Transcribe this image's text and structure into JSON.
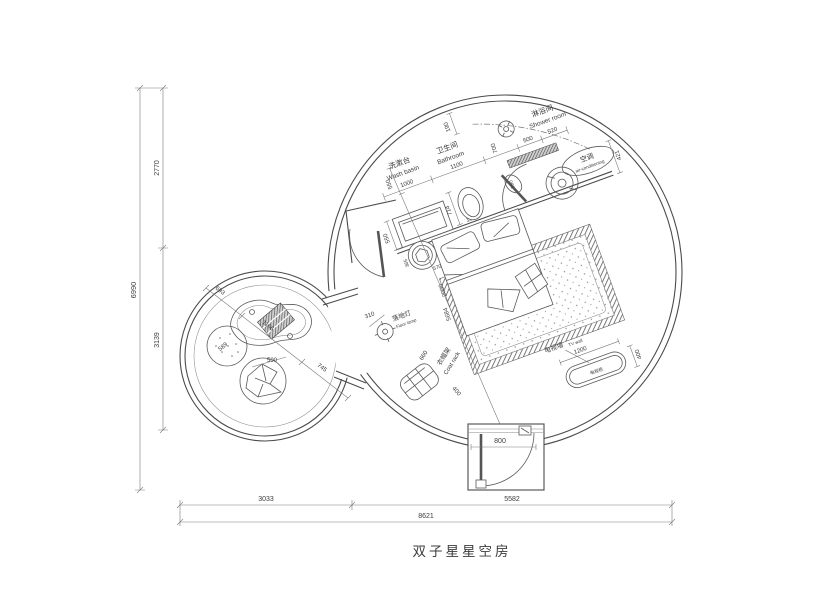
{
  "title": "双子星星空房",
  "rooms": {
    "washbasin": {
      "cn": "洗漱台",
      "en": "Wash basin"
    },
    "bathroom": {
      "cn": "卫生间",
      "en": "Bathroom"
    },
    "shower": {
      "cn": "淋浴间",
      "en": "Shower room"
    },
    "ac": {
      "cn": "空调",
      "en": "air-conditioning"
    },
    "tv_wall": {
      "cn": "电视墙",
      "en": "TV wall"
    },
    "tv_cabinet": {
      "cn": "电视柜"
    },
    "floor_lamp": {
      "cn": "落地灯",
      "en": "Floor lamp"
    },
    "coat_rack": {
      "cn": "衣帽架",
      "en": "Coat rack"
    }
  },
  "dims": {
    "overall_w": "8621",
    "w_left": "3033",
    "w_right": "5582",
    "overall_h": "6990",
    "h_top": "2770",
    "h_mid": "3139",
    "chain_washbasin": "1000",
    "chain_bathroom": "1100",
    "chain_door": "700",
    "chain_shower": "500",
    "chain_step": "520",
    "ac_depth": "421",
    "wall_gap": "190",
    "toilet": "714",
    "vanity_depth": "550",
    "door_leaf": "590",
    "bed_w": "1800",
    "bed_l": "2000",
    "room_diag": "5684",
    "stool_a": "365",
    "stool_b": "570",
    "tv_w": "1200",
    "tv_d": "400",
    "coat_w": "660",
    "coat_d": "400",
    "lamp": "310",
    "entry_door": "800",
    "small_a": "693",
    "small_b": "1166",
    "small_c": "745",
    "pouf": "589",
    "beanbag": "500"
  }
}
